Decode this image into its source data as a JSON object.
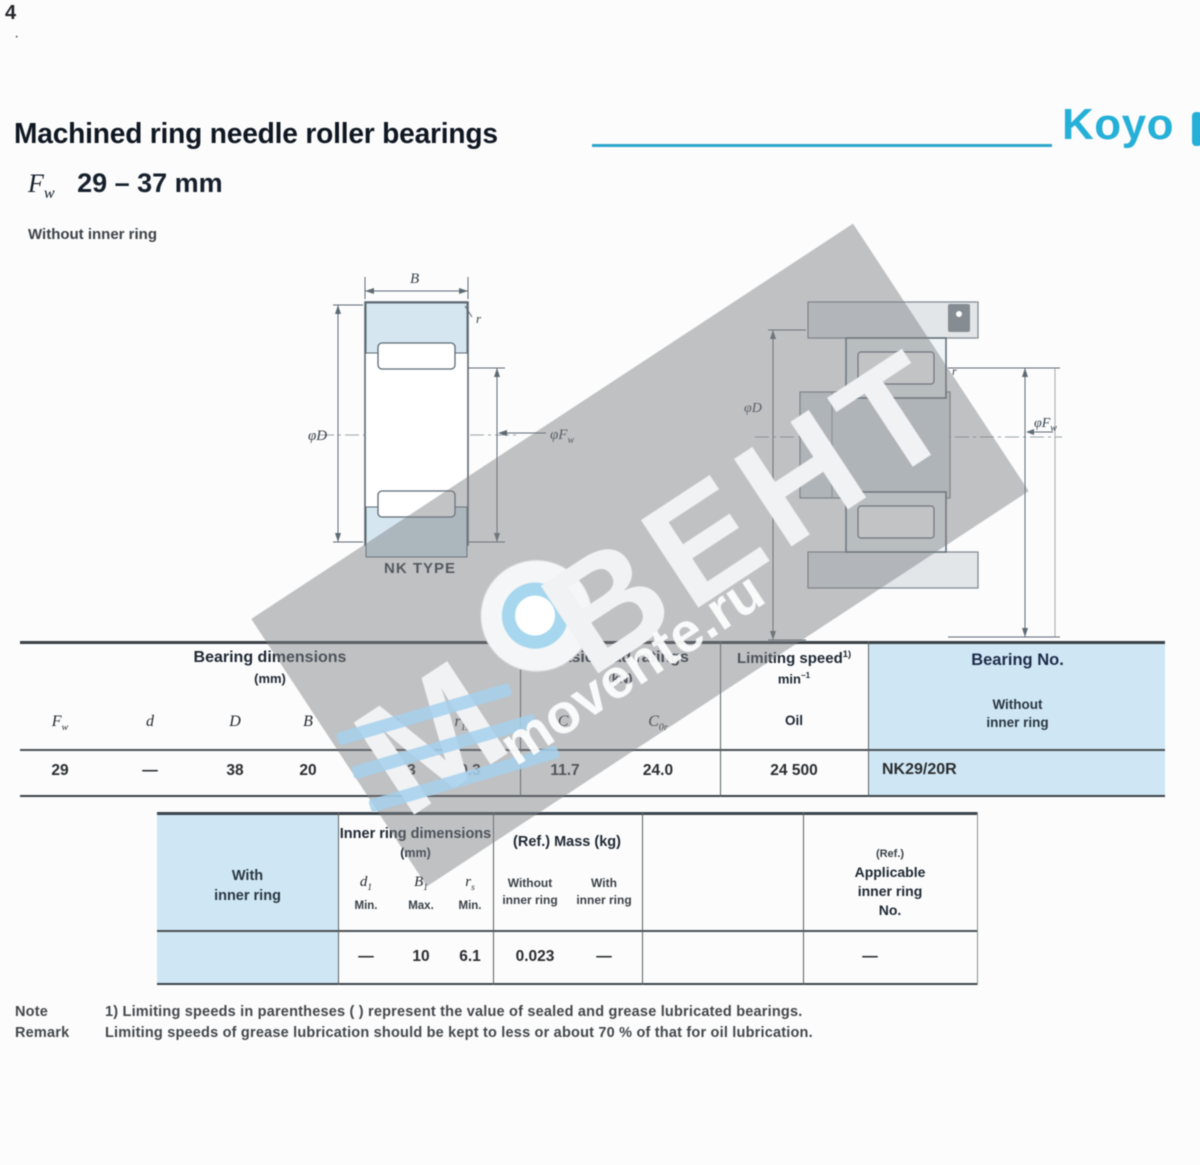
{
  "page": {
    "corner_mark1": "4",
    "corner_mark2": "·",
    "title": "Machined ring needle roller bearings",
    "size_prefix_main": "F",
    "size_prefix_sub": "w",
    "size_range": "29 – 37 mm",
    "subtitle": "Without inner ring",
    "brand": "Koyo",
    "footnote": {
      "note_label": "Note",
      "note_text": "1) Limiting speeds in parentheses (  ) represent the value of sealed and grease lubricated bearings.",
      "remark_label": "Remark",
      "remark_text": "Limiting speeds of grease lubrication should be kept to less or about 70 % of that for oil lubrication."
    }
  },
  "diagram_left": {
    "caption": "NK TYPE",
    "dim_b": "B",
    "dim_d": "φD",
    "dim_fw_main": "φF",
    "dim_fw_sub": "w",
    "dim_r": "r"
  },
  "diagram_right": {
    "dim_d": "φD",
    "dim_fw_main": "φF",
    "dim_fw_sub": "w",
    "dim_r": "r"
  },
  "table1": {
    "group_dims": "Bearing dimensions",
    "group_dims_unit": "(mm)",
    "group_load": "Basic load ratings",
    "group_load_unit": "(kN)",
    "group_speed_main": "Limiting speed",
    "group_speed_ref": "1)",
    "group_speed_unit_main": "min",
    "group_speed_unit_sup": "−1",
    "group_speed_sub": "Oil",
    "group_no": "Bearing No.",
    "group_no_sub1": "Without",
    "group_no_sub2": "inner ring",
    "cols": {
      "fw_main": "F",
      "fw_sub": "w",
      "d": "d",
      "D": "D",
      "B": "B",
      "rs_main": "r",
      "rs_sub": "s",
      "r1s_main": "r",
      "r1s_sub": "1s",
      "cr_main": "C",
      "cr_sub": "r",
      "c0r_main": "C",
      "c0r_sub": "0r"
    },
    "row": {
      "fw": "29",
      "d": "—",
      "D": "38",
      "B": "20",
      "rs": "0.3",
      "r1s": "0.3",
      "cr": "11.7",
      "c0r": "24.0",
      "speed": "24 500",
      "no": "NK29/20R"
    }
  },
  "table2": {
    "left_header1": "With",
    "left_header2": "inner ring",
    "group_dims": "Inner ring dimensions",
    "group_dims_unit": "(mm)",
    "cols": {
      "d1_main": "d",
      "d1_sub": "1",
      "d1_note": "Min.",
      "b1_main": "B",
      "b1_sub": "1",
      "b1_note": "Max.",
      "rs_main": "r",
      "rs_sub": "s",
      "rs_note": "Min."
    },
    "group_mass": "(Ref.) Mass (kg)",
    "mass_col1a": "Without",
    "mass_col1b": "inner ring",
    "mass_col2a": "With",
    "mass_col2b": "inner ring",
    "ref_line0": "(Ref.)",
    "ref_line1": "Applicable",
    "ref_line2": "inner ring",
    "ref_line3": "No.",
    "row": {
      "d1": "—",
      "b1": "10",
      "rs": "6.1",
      "mass_without": "0.023",
      "mass_inner": "—",
      "ref_no": "—"
    }
  },
  "watermark": {
    "brand": "ВЕНТ",
    "logo_letter": "M",
    "url": "movente.ru"
  },
  "colors": {
    "brand_cyan": "#25b0d8",
    "rule_blue": "#2da6cb",
    "header_navy": "#1d2733",
    "cell_blue": "#cfe7f4"
  }
}
